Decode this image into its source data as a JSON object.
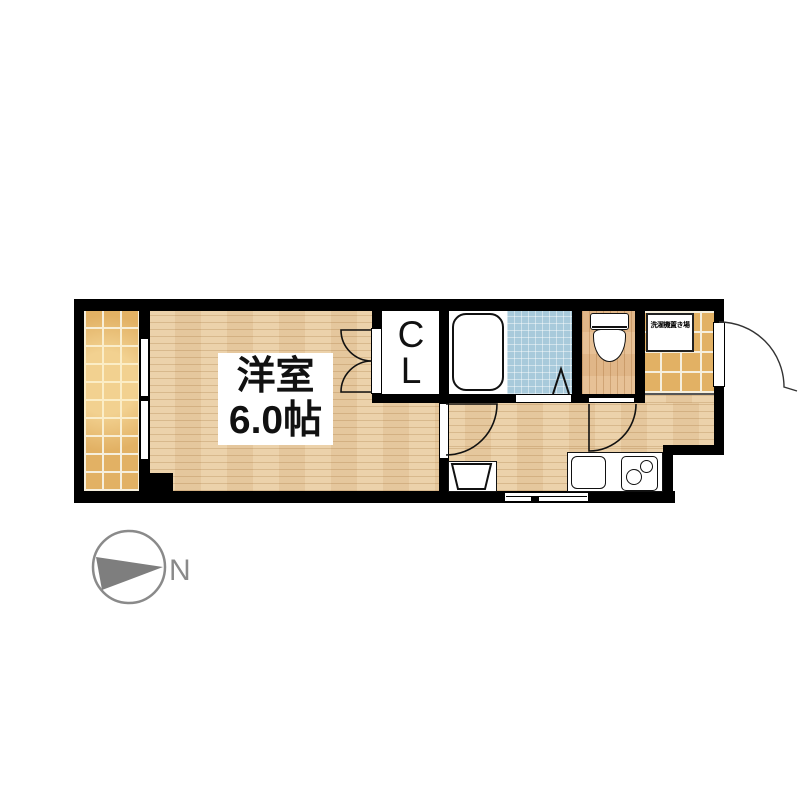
{
  "labels": {
    "main_room_line1": "洋室",
    "main_room_line2": "6.0帖",
    "closet_line1": "C",
    "closet_line2": "L",
    "washer_area": "洗濯機置き場",
    "compass_north": "N"
  },
  "colors": {
    "wall": "#000000",
    "paper": "#ffffff",
    "wood-floor": "#ebcfa6",
    "toilet-floor": "#e6bd90",
    "tile": "#e2b164",
    "grout": "#f6efdd",
    "bath-tile": "#a8cadb",
    "fixture-outline": "#111111",
    "compass-gray": "#8a8a8a"
  }
}
